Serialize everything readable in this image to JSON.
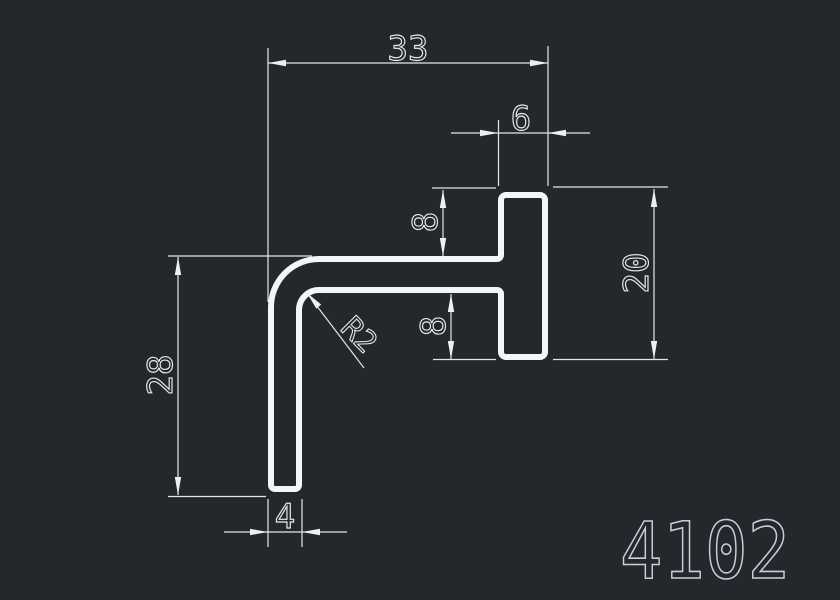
{
  "drawing": {
    "part_number": "4102",
    "dims": {
      "width_total": "33",
      "head_width": "6",
      "offset_top": "8",
      "offset_bottom": "8",
      "head_height": "20",
      "height_total": "28",
      "leg_thickness": "4",
      "corner_radius": "R2"
    },
    "colors": {
      "background": "#24282d",
      "profile_line": "#f3f6f7",
      "dimension_line": "#e2e6ea",
      "dimension_text": "#e6eaee",
      "part_number_text": "#c9cfd6"
    }
  }
}
